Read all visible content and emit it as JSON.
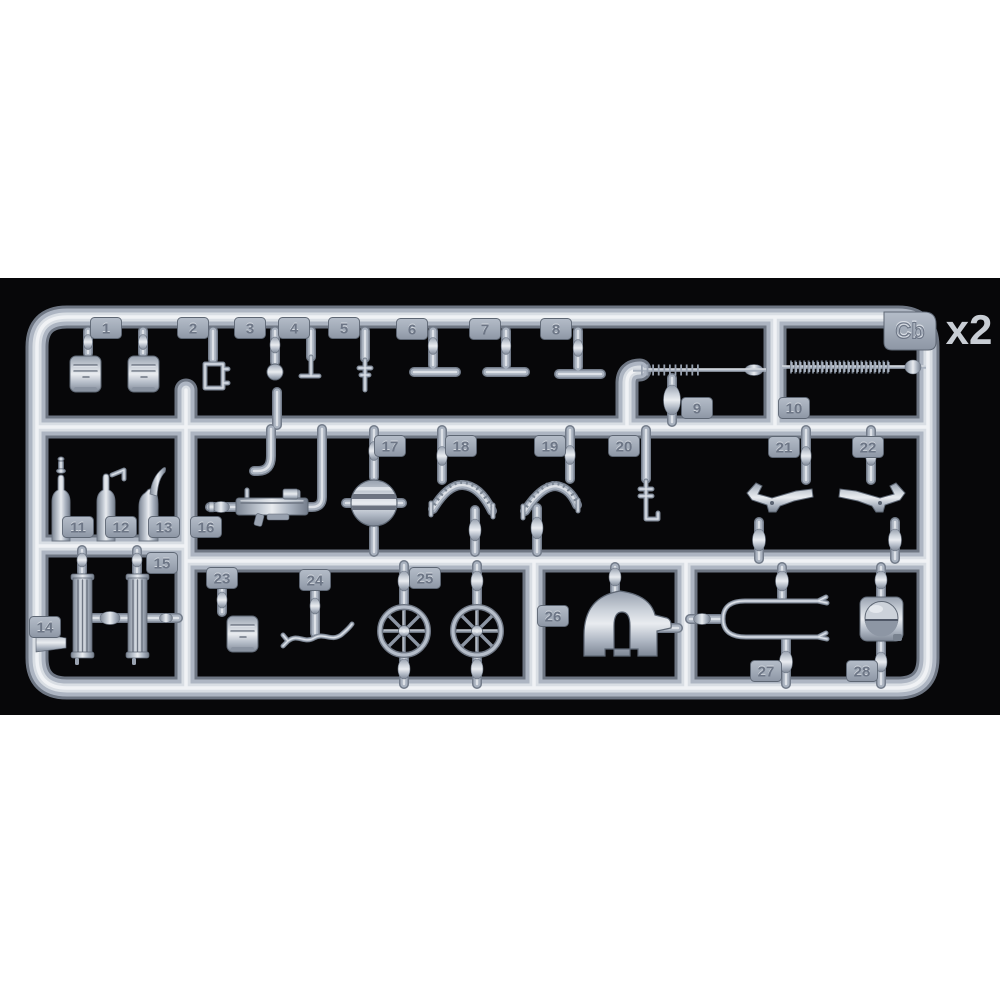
{
  "sprue": {
    "code": "Cb",
    "quantity_label": "x2",
    "part_numbers_visible": "1-28"
  },
  "parts": [
    {
      "number": "1"
    },
    {
      "number": "2"
    },
    {
      "number": "3"
    },
    {
      "number": "4"
    },
    {
      "number": "5"
    },
    {
      "number": "6"
    },
    {
      "number": "7"
    },
    {
      "number": "8"
    },
    {
      "number": "9"
    },
    {
      "number": "10"
    },
    {
      "number": "11"
    },
    {
      "number": "12"
    },
    {
      "number": "13"
    },
    {
      "number": "14"
    },
    {
      "number": "15"
    },
    {
      "number": "16"
    },
    {
      "number": "17"
    },
    {
      "number": "18"
    },
    {
      "number": "19"
    },
    {
      "number": "20"
    },
    {
      "number": "21"
    },
    {
      "number": "22"
    },
    {
      "number": "23"
    },
    {
      "number": "24"
    },
    {
      "number": "25"
    },
    {
      "number": "26"
    },
    {
      "number": "27"
    },
    {
      "number": "28"
    }
  ],
  "colors": {
    "page_background": "#ffffff",
    "photo_background": "#070709",
    "plastic_mid": "#adb5c2",
    "plastic_highlight": "#f0f2f5",
    "plastic_shadow": "#6e7683",
    "tag_plate": "#9aa3b1",
    "tag_number": "#6d7686",
    "quantity_text": "#c8cdd4"
  }
}
